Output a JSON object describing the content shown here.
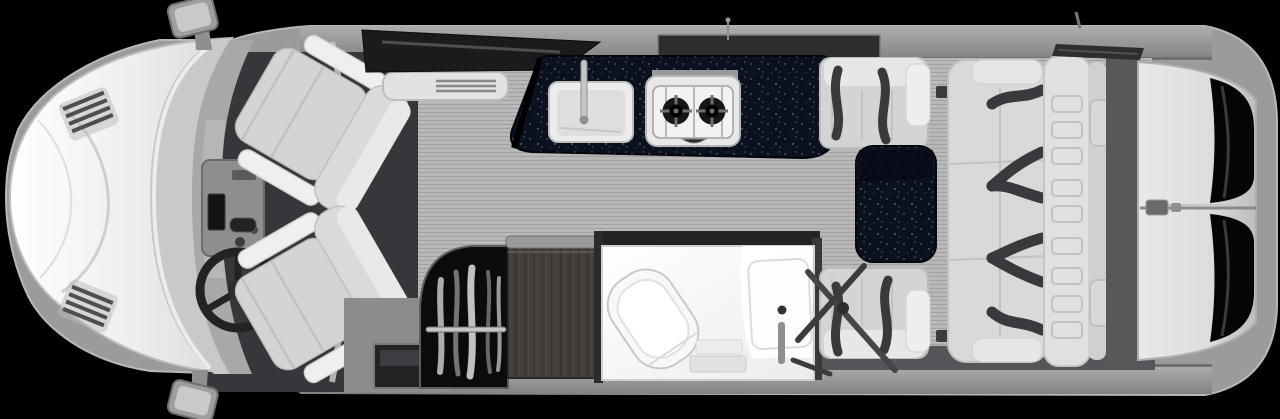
{
  "meta": {
    "title": "Class B motorhome floor plan - top-down interior rendering",
    "view": "top-down",
    "width_px": 1280,
    "height_px": 419
  },
  "colors": {
    "background": "#000000",
    "body_shell": "#9b9b9b",
    "wall_band": "#8f8f8f",
    "floor": "#b5b5b5",
    "cab_floor": "#35373a",
    "countertop": "#0c1120",
    "table": "#0c1120",
    "seat": "#d4d4d4",
    "sofa": "#d9d9d9",
    "seatbelt": "#3a3a3e",
    "bathroom": "#f7f7f7",
    "wood_cabinet": "#433f3a",
    "closet_interior": "#0b0b0c",
    "window_glass": "#050505",
    "rear_doors": "#dcdcdc",
    "nose": "#f0f0f0",
    "windshield": "#c9c9c9",
    "chrome": "#c6c6c6"
  },
  "zones": {
    "cab": {
      "name": "cab",
      "features": [
        "hood",
        "hood-vents",
        "windshield",
        "dashboard",
        "center-console",
        "steering-wheel",
        "passenger-swivel-seat",
        "driver-swivel-seat",
        "side-mirror-top",
        "side-mirror-bottom"
      ]
    },
    "entry": {
      "name": "entry",
      "features": [
        "entry-step-well",
        "heater-vent"
      ]
    },
    "galley": {
      "name": "galley",
      "features": [
        "solid-surface-countertop",
        "sink",
        "faucet",
        "two-burner-cooktop",
        "overhead-tv",
        "galley-window"
      ]
    },
    "wardrobe": {
      "name": "wardrobe",
      "features": [
        "hanging-closet",
        "clothes-rod",
        "hanging-clothes",
        "wood-cabinet"
      ]
    },
    "bathroom": {
      "name": "wet-bath",
      "features": [
        "toilet",
        "shower-pan",
        "shower-column",
        "shower-control"
      ]
    },
    "dinette": {
      "name": "dinette",
      "features": [
        "forward-facing-seat",
        "rear-facing-seat",
        "pedestal-table",
        "folded-table-legs",
        "seatbelts"
      ]
    },
    "rear_lounge": {
      "name": "rear-lounge",
      "features": [
        "three-seat-sofa",
        "sofa-seatbelts",
        "sofa-backrest",
        "headrest-pads"
      ]
    },
    "rear": {
      "name": "rear",
      "features": [
        "rear-doors",
        "rear-door-window-top",
        "rear-door-window-bottom",
        "door-latch",
        "roof-vent",
        "antenna"
      ]
    }
  }
}
